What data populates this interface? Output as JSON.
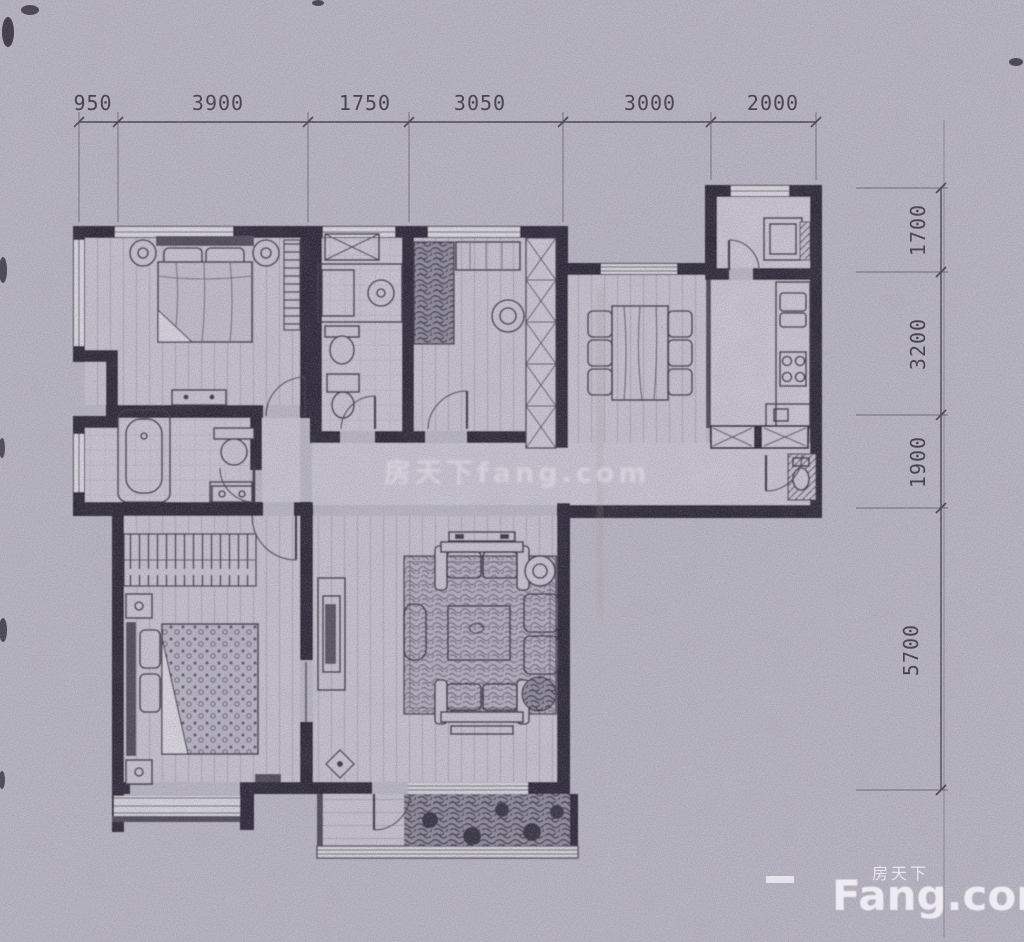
{
  "dimensions": {
    "top": [
      "950",
      "3900",
      "1750",
      "3050",
      "3000",
      "2000"
    ],
    "right": [
      "1700",
      "3200",
      "1900",
      "5700"
    ]
  },
  "watermarks": {
    "center": "房天下fang.com",
    "brand_cn": "房天下",
    "brand_en": "Fang.com"
  },
  "colors": {
    "paper": "#b9b6c3",
    "wall_ink": "#2c2835",
    "dimension_text": "#3e3a49",
    "watermark": "#f5f4f8"
  }
}
